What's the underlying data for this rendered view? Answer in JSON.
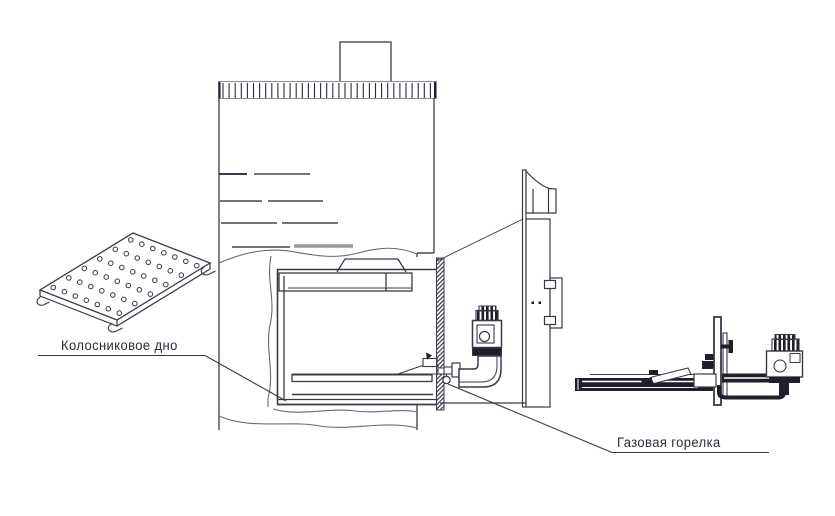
{
  "diagram": {
    "type": "technical-drawing",
    "subject": "gas heater furnace with burner assembly",
    "labels": {
      "grate": "Колосниковое дно",
      "burner": "Газовая горелка"
    },
    "parts": [
      "chimney",
      "ribbed-collar",
      "furnace-body",
      "firebox",
      "grate-plate",
      "gasket-strip",
      "gas-valve",
      "elbow-pipe",
      "mounting-plate",
      "burner-detail-view"
    ],
    "colors": {
      "line": "#3b3847",
      "line_light": "#8f8a9b",
      "fill_dark": "#211e2b",
      "background": "#ffffff",
      "label_text": "#2e2b38"
    }
  }
}
